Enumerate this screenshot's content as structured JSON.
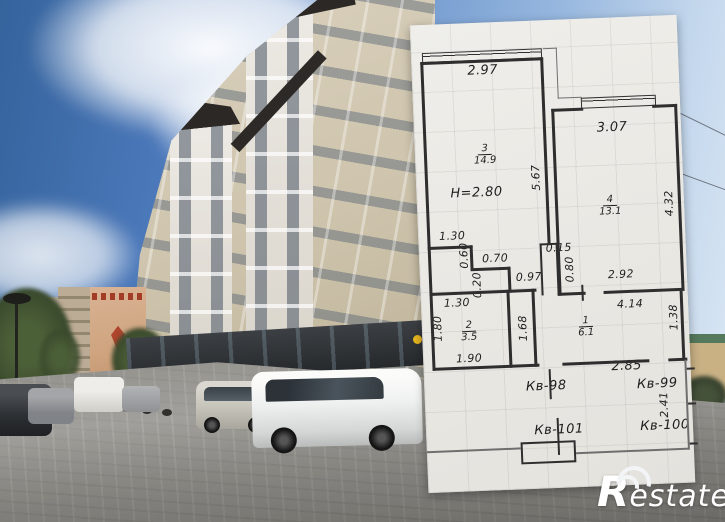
{
  "floor_plan": {
    "ceiling_height_label": "H=2.80",
    "rooms": {
      "living": {
        "number": "3",
        "area": "14.9"
      },
      "bedroom": {
        "number": "4",
        "area": "13.1"
      },
      "bath": {
        "number": "2",
        "area": "3.5"
      },
      "hall": {
        "number": "1",
        "area": "6.1"
      }
    },
    "dims": {
      "room3_top": "2.97",
      "room3_right": "5.67",
      "room3_bottom": "1.30",
      "room4_top": "3.07",
      "room4_right": "4.32",
      "room4_bottom": "2.92",
      "niche_height": "0.60",
      "niche_width": "0.70",
      "niche_step": "0.20",
      "closet_top": "0.97",
      "closet_height": "1.68",
      "shaft_width": "0.15",
      "shaft_height": "0.80",
      "hall_top": "4.14",
      "hall_right": "1.38",
      "bath_top": "1.30",
      "bath_left": "1.80",
      "bath_bottom": "1.90",
      "lobby_width": "2.85",
      "lobby_height": "2.41"
    },
    "apartments": {
      "kv98": "Кв-98",
      "kv99": "Кв-99",
      "kv100": "Кв-100",
      "kv101": "Кв-101"
    }
  },
  "watermark": {
    "initial": "R",
    "rest": "estate"
  }
}
